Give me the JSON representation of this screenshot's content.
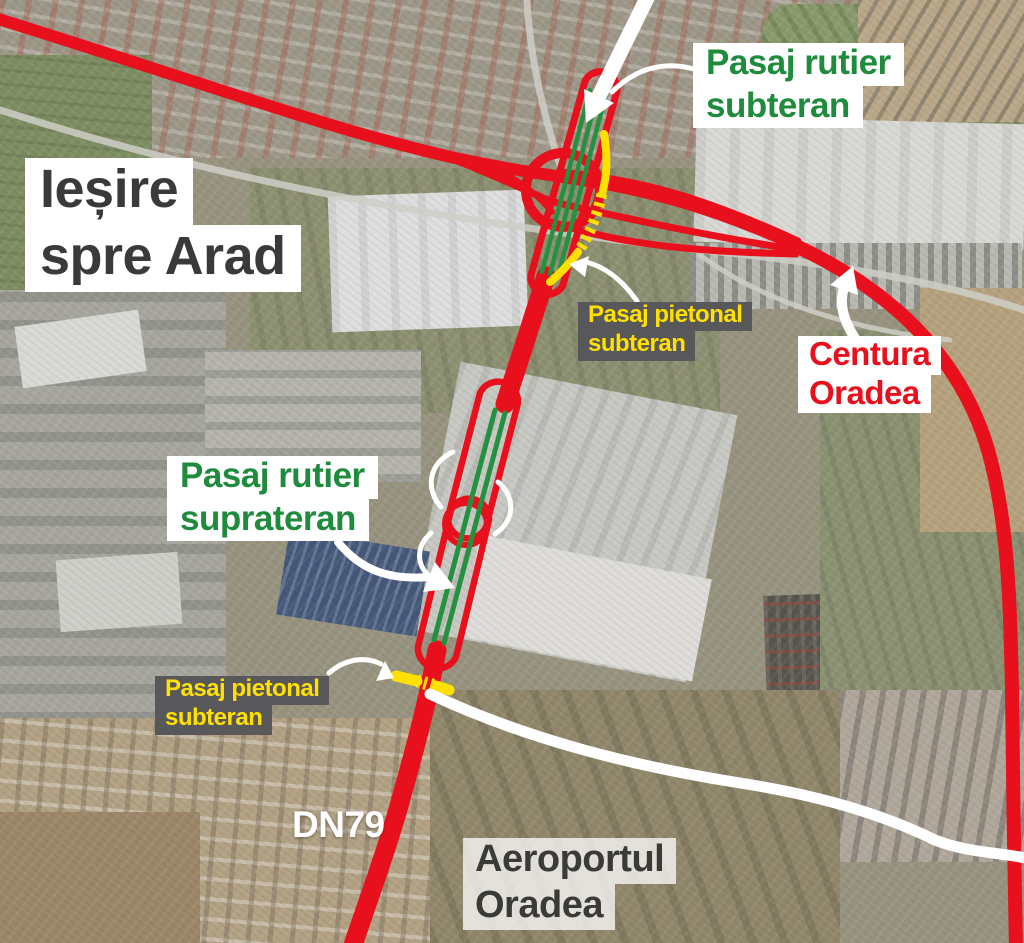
{
  "colors": {
    "road_red": "#e8101c",
    "passage_green": "#1e8b3d",
    "pedestrian_yellow": "#ffe000",
    "label_gray_bg": "#58585a",
    "dark_text": "#3a3a39",
    "white": "#ffffff"
  },
  "labels": {
    "exit": {
      "line1": "Ieșire",
      "line2": "spre Arad"
    },
    "underpass": {
      "line1": "Pasaj rutier",
      "line2": "subteran"
    },
    "pedestrian_top": {
      "line1": "Pasaj pietonal",
      "line2": "subteran"
    },
    "ring_road": {
      "line1": "Centura",
      "line2": "Oradea"
    },
    "overpass": {
      "line1": "Pasaj rutier",
      "line2": "suprateran"
    },
    "pedestrian_bottom": {
      "line1": "Pasaj pietonal",
      "line2": "subteran"
    },
    "road_number": "DN79",
    "airport": {
      "line1": "Aeroportul",
      "line2": "Oradea"
    }
  }
}
